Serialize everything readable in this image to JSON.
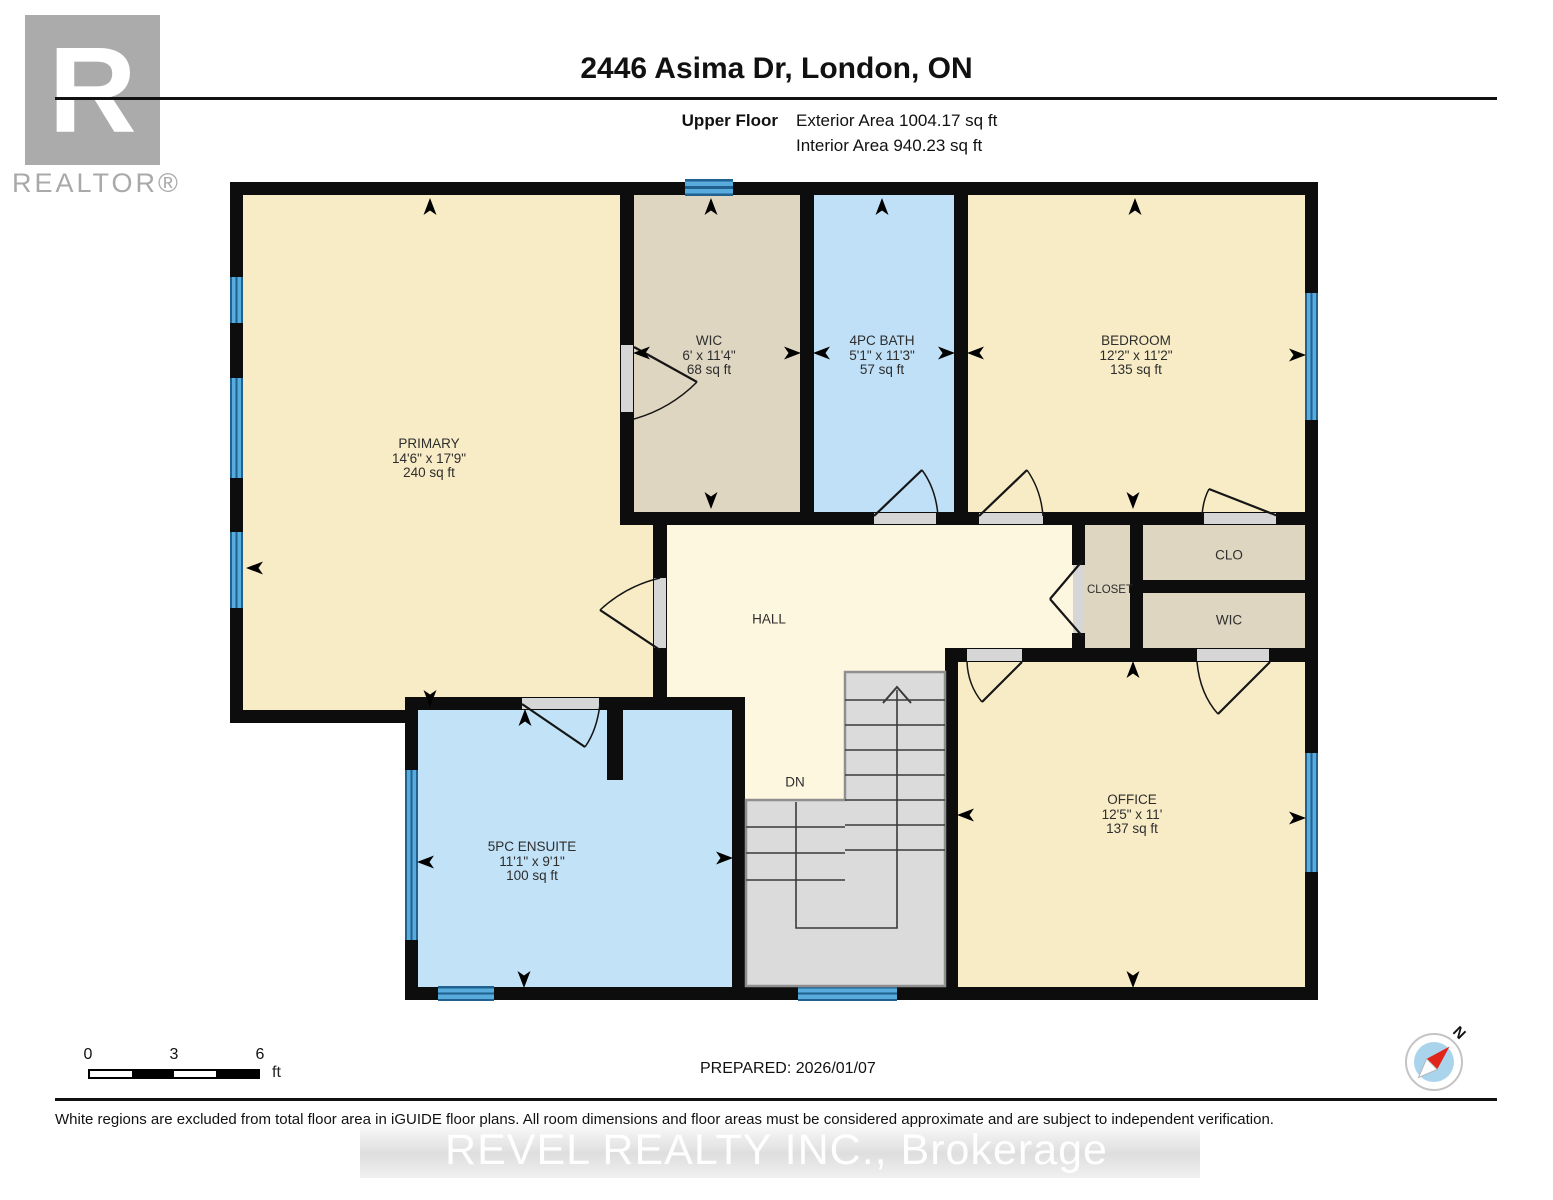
{
  "header": {
    "title": "2446 Asima Dr, London, ON",
    "floor_label": "Upper Floor",
    "exterior_area": "Exterior Area 1004.17 sq ft",
    "interior_area": "Interior Area 940.23 sq ft"
  },
  "branding": {
    "logo_letter": "R",
    "realtor": "REALTOR®"
  },
  "rooms": [
    {
      "name": "PRIMARY",
      "dims": "14'6\" x 17'9\"",
      "area": "240 sq ft"
    },
    {
      "name": "WIC",
      "dims": "6' x 11'4\"",
      "area": "68 sq ft"
    },
    {
      "name": "4PC BATH",
      "dims": "5'1\" x 11'3\"",
      "area": "57 sq ft"
    },
    {
      "name": "BEDROOM",
      "dims": "12'2\" x 11'2\"",
      "area": "135 sq ft"
    },
    {
      "name": "5PC ENSUITE",
      "dims": "11'1\" x 9'1\"",
      "area": "100 sq ft"
    },
    {
      "name": "OFFICE",
      "dims": "12'5\" x 11'",
      "area": "137 sq ft"
    }
  ],
  "labels": {
    "hall": "HALL",
    "closet": "CLOSET",
    "clo": "CLO",
    "wic": "WIC",
    "dn": "DN"
  },
  "compass": {
    "north": "N"
  },
  "scale": {
    "t0": "0",
    "t3": "3",
    "t6": "6",
    "unit": "ft"
  },
  "footer": {
    "prepared": "PREPARED: 2026/01/07",
    "disclaimer": "White regions are excluded from total floor area in iGUIDE floor plans. All room dimensions and floor areas must be considered approximate and are subject to independent verification.",
    "watermark": "REVEL REALTY INC., Brokerage"
  },
  "colors": {
    "wall": "#0d0d0d",
    "room_cream": "#f8ecc6",
    "hall_cream": "#fdf7e0",
    "closet_tan": "#dfd6c2",
    "bath_blue": "#bfe0f6",
    "window_blue": "#58acdd",
    "stairs_gray": "#dbdbdb",
    "compass_red": "#e1251b",
    "compass_blue": "#a9d4ec"
  }
}
